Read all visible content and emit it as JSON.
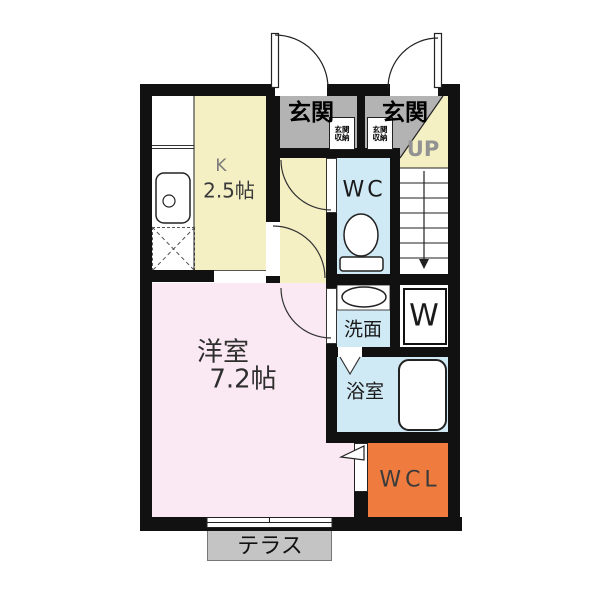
{
  "plan": {
    "title": "1K apartment floor plan",
    "rooms": {
      "entrance_left": {
        "label": "玄関"
      },
      "entrance_right": {
        "label": "玄関"
      },
      "entrance_storage_left": {
        "line1": "玄関",
        "line2": "収納"
      },
      "entrance_storage_right": {
        "line1": "玄関",
        "line2": "収納"
      },
      "kitchen": {
        "label": "K",
        "size": "2.5帖"
      },
      "wc": {
        "label": "WC"
      },
      "stairs": {
        "label": "UP"
      },
      "washroom": {
        "label": "洗面"
      },
      "washer": {
        "label": "W"
      },
      "bathroom": {
        "label": "浴室"
      },
      "western_room": {
        "label": "洋室",
        "size": "7.2帖"
      },
      "walk_in_closet": {
        "label": "WCL"
      },
      "terrace": {
        "label": "テラス"
      }
    },
    "colors": {
      "wall": "#111111",
      "entrance_floor": "#b3b3b3",
      "kitchen_hall_floor": "#f5f0c4",
      "wet_area_floor": "#cfe9f5",
      "room_floor": "#fae9f2",
      "closet_floor": "#ef7c3e",
      "terrace_floor": "#c4c4c4"
    }
  }
}
